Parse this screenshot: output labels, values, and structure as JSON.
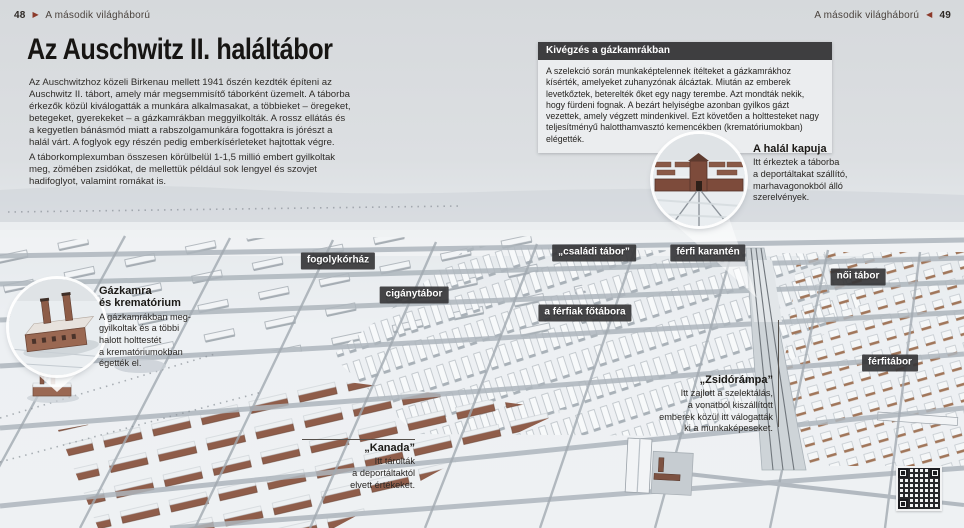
{
  "page": {
    "header_left": {
      "page_number": "48",
      "arrow": "▶",
      "chapter": "A második világháború"
    },
    "header_right": {
      "chapter": "A második világháború",
      "arrow": "◀",
      "page_number": "49"
    }
  },
  "article": {
    "title": "Az Auschwitz II. haláltábor",
    "paragraphs": [
      "Az Auschwitzhoz közeli Birkenau mellett 1941 őszén kezdték építeni az Auschwitz II. tábort, amely már megsemmisítő táborként üzemelt. A táborba érkezők közül kiválogatták a munkára alkalmasakat, a többieket – öregeket, betegeket, gyerekeket – a gázkamrákban meggyilkolták. A rossz ellátás és a kegyetlen bánásmód miatt a rabszolgamunkára fogottakra is jórészt a halál várt. A foglyok egy részén pedig emberkísérleteket hajtottak végre.",
      "A táborkomplexumban összesen körülbelül 1-1,5 millió embert gyilkoltak meg, zömében zsidókat, de mellettük például sok lengyel és szovjet hadifoglyot, valamint romákat is."
    ]
  },
  "infobox": {
    "title": "Kivégzés a gázkamrákban",
    "body": "A szelekció során munkaképtelennek ítélteket a gázkamrákhoz kísérték, amelyeket zuhanyzónak álcáztak. Miután az emberek levetkőztek, beterelték őket egy nagy terembe. Azt mondták nekik, hogy fürdeni fognak. A bezárt helyiségbe azonban gyilkos gázt vezettek, amely végzett mindenkivel. Ezt követően a holttesteket nagy teljesítményű halotthamvasztó kemencékben (krematóriumokban) elégették."
  },
  "callouts": {
    "death_gate": {
      "title": "A halál kapuja",
      "body": "Itt érkeztek a táborba\na deportáltakat szállító,\nmarhavagonokból álló\nszerelvények."
    },
    "gas_chamber": {
      "title": "Gázkamra\nés krematórium",
      "body": "A gázkamrákban meg-\ngyilkoltak és a többi\nhalott holttestét\na krematóriumokban\négették el."
    },
    "jewish_ramp": {
      "title": "„Zsidórámpa”",
      "body": "Itt zajlott a szelektálás,\na vonatból kiszállított\nemberek közül itt válogatták\nki a munkaképeseket."
    },
    "kanada": {
      "title": "„Kanada”",
      "body": "Itt tárolták\na deportáltaktól\nelvett értékeket."
    }
  },
  "map_labels": [
    {
      "id": "fogolykorhaz",
      "label": "fogolykórház"
    },
    {
      "id": "ciganytabor",
      "label": "cigánytábor"
    },
    {
      "id": "csaladi-tabor",
      "label": "„családi tábor”"
    },
    {
      "id": "ferfi-karanten",
      "label": "férfi karantén"
    },
    {
      "id": "ferfiak-fotabora",
      "label": "a férfiak főtábora"
    },
    {
      "id": "noi-tabor",
      "label": "női tábor"
    },
    {
      "id": "ferfitabor",
      "label": "férfitábor"
    }
  ],
  "colors": {
    "label_bg": "#38383a",
    "infobox_header_bg": "#3e3e40",
    "arrow_accent": "#8c3a2a",
    "brick": "#8f5d4a",
    "snow": "#e9edf0"
  }
}
